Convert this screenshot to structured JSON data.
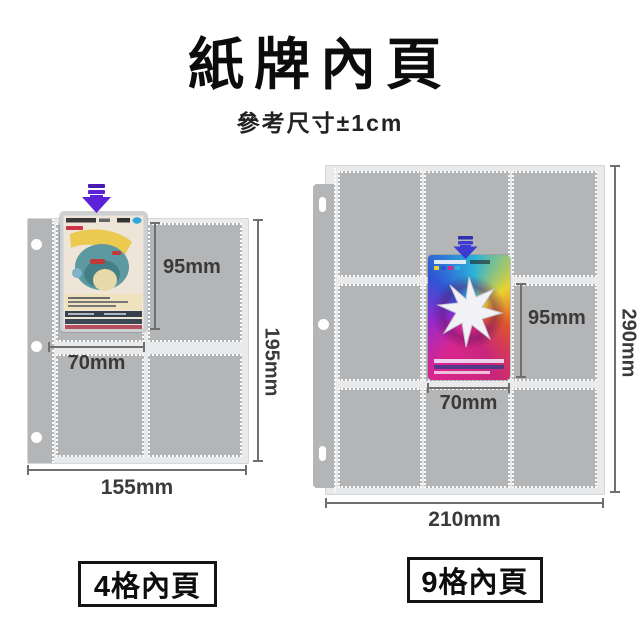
{
  "header": {
    "title": "紙牌內頁",
    "subtitle": "參考尺寸±1cm"
  },
  "four_pocket": {
    "caption": "4格內頁",
    "card_height": "95mm",
    "card_width": "70mm",
    "page_height": "195mm",
    "page_width": "155mm"
  },
  "nine_pocket": {
    "caption": "9格內頁",
    "card_height": "95mm",
    "card_width": "70mm",
    "page_height": "290mm",
    "page_width": "210mm"
  },
  "icons": {
    "four_pocket_insert": "down-arrow",
    "nine_pocket_insert": "down-arrow"
  },
  "colors": {
    "arrow_purple": "#5b22d8",
    "arrow_blue": "#3d3ad2",
    "pocket_gray": "#b4b5b7",
    "stitch_white": "#fdfdfd",
    "dimension_line": "#6f6f6f",
    "text_dark": "#111111"
  }
}
